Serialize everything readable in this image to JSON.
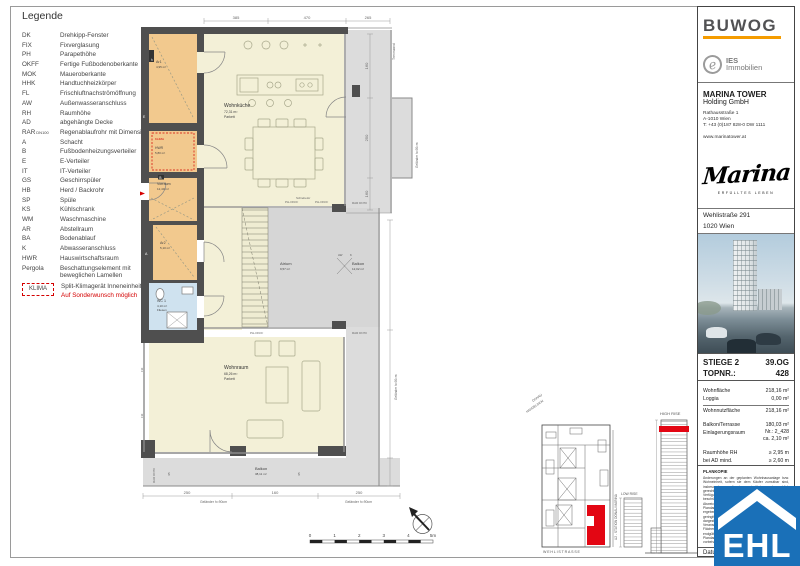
{
  "colors": {
    "red": "#e30613",
    "orange_bar": "#f59c00",
    "ehl_blue": "#1a70b8",
    "wall": "#4f4f4f",
    "room_cream": "#f3f0d7",
    "room_orange": "#f2c98e",
    "room_blue": "#cfe2ef",
    "terrace": "#dcdcdc"
  },
  "legend": {
    "title": "Legende",
    "rows": [
      {
        "abbr": "DK",
        "desc": "Drehkipp-Fenster"
      },
      {
        "abbr": "FIX",
        "desc": "Fixverglasung"
      },
      {
        "abbr": "PH",
        "desc": "Parapethöhe"
      },
      {
        "abbr": "OKFF",
        "desc": "Fertige Fußbodenoberkante"
      },
      {
        "abbr": "MOK",
        "desc": "Maueroberkante"
      },
      {
        "abbr": "HHK",
        "desc": "Handtuchheizkörper"
      },
      {
        "abbr": "FL",
        "desc": "Frischluftnachströmöffnung"
      },
      {
        "abbr": "AW",
        "desc": "Außenwasseranschluss"
      },
      {
        "abbr": "RH",
        "desc": "Raumhöhe"
      },
      {
        "abbr": "AD",
        "desc": "abgehängte Decke"
      },
      {
        "abbr": "RAR",
        "abbr_sub": "DN100",
        "desc": "Regenablaufrohr mit Dimension"
      },
      {
        "abbr": "A",
        "desc": "Schacht"
      },
      {
        "abbr": "B",
        "desc": "Fußbodenheizungsverteiler"
      },
      {
        "abbr": "E",
        "desc": "E-Verteiler"
      },
      {
        "abbr": "IT",
        "desc": "IT-Verteiler"
      },
      {
        "abbr": "GS",
        "desc": "Geschirrspüler"
      },
      {
        "abbr": "HB",
        "desc": "Herd / Backrohr"
      },
      {
        "abbr": "SP",
        "desc": "Spüle"
      },
      {
        "abbr": "KS",
        "desc": "Kühlschrank"
      },
      {
        "abbr": "WM",
        "desc": "Waschmaschine"
      },
      {
        "abbr": "AR",
        "desc": "Abstellraum"
      },
      {
        "abbr": "BA",
        "desc": "Bodenablauf"
      },
      {
        "abbr": "K",
        "desc": "Abwasseranschluss"
      },
      {
        "abbr": "HWR",
        "desc": "Hauswirtschaftsraum"
      },
      {
        "abbr": "Pergola",
        "desc": "Beschattungselement mit beweglichen Lamellen"
      }
    ],
    "klima": {
      "abbr": "KLIMA",
      "desc": "Split-Klimagerät Inneneinheit",
      "note": "Auf Sonderwunsch möglich"
    }
  },
  "plan": {
    "rooms": {
      "wohnkueche": {
        "name": "Wohnküche",
        "area": "72,31 m²",
        "floor": "Parkett"
      },
      "wohnraum": {
        "name": "Wohnraum",
        "area": "68,26 m²",
        "floor": "Parkett"
      },
      "vorraum": {
        "name": "Vorraum",
        "area": "12,40 m²"
      },
      "ar1": {
        "name": "Ar1",
        "area": "4,95 m²"
      },
      "hwr": {
        "name": "HWR",
        "area": "5,80 m²"
      },
      "ar2": {
        "name": "Ar2",
        "area": "5,10 m²"
      },
      "wc": {
        "name": "WC 1",
        "area": "4,10 m²",
        "floor": "Fliesen"
      },
      "atrium": {
        "name": "Atrium",
        "area": "9,57 m²"
      },
      "balkon_o": {
        "name": "Balkon",
        "area": "12,02 m²"
      },
      "balkon_u": {
        "name": "Balkon",
        "area": "38,11 m²"
      }
    },
    "marker": {
      "line1": "TOP",
      "line2": "428"
    },
    "labels": {
      "trennwand": "Trennwand",
      "gelaender": "Geländer h=90cm",
      "rar": "RAR DN70",
      "ph_okff": "PH-OKFF",
      "schiebetuer": "Schiebetür",
      "aw": "AW",
      "k": "K",
      "klima": "KLIMA",
      "it": "IT",
      "e": "E",
      "b": "B",
      "a": "A",
      "fix": "FIX"
    },
    "dims": {
      "top": [
        "385",
        "470",
        "265"
      ],
      "right": [
        "160",
        "250",
        "160"
      ],
      "bottom": [
        "250",
        "160",
        "250"
      ],
      "balcony": [
        "95",
        "95"
      ]
    }
  },
  "site_plan": {
    "street": "WEHLISTRASSE",
    "ubahn": "U2 - STATION DONAU MARINA",
    "donau": "DONAU",
    "handelskai": "HANDELSKAI",
    "low_rise": "LOW RISE",
    "high_rise": "HIGH RISE"
  },
  "scale_bar": {
    "labels": [
      "0",
      "1",
      "2",
      "3",
      "4",
      "5m"
    ]
  },
  "sidebar": {
    "buwog": "BUWOG",
    "ies": {
      "name": "IES",
      "sub": "Immobilien",
      "glyph": "e"
    },
    "company": {
      "name": "MARINA TOWER",
      "sub": "Holding GmbH",
      "address1": "Rathausstraße 1",
      "address2": "A-1010 Wien",
      "phone": "T: +43 (0)187 828-0 DW 1111",
      "web": "www.marinatower.at"
    },
    "marina": {
      "logo": "Marina",
      "tagline": "ERFÜLLTES LEBEN"
    },
    "project": {
      "street": "Wehlistraße 291",
      "city": "1020 Wien"
    },
    "unit": {
      "stiege": "STIEGE 2",
      "floor": "39.OG",
      "topnr_label": "TOPNR.:",
      "topnr": "428"
    },
    "areas": [
      {
        "label": "Wohnfläche",
        "value": "218,16 m²"
      },
      {
        "label": "Loggia",
        "value": "0,00 m²"
      },
      {
        "label": "Wohnnutzfläche",
        "value": "218,16 m²"
      },
      {
        "label": "Balkon/Terrasse",
        "value": "180,03 m²"
      },
      {
        "label": "Einlagerungsraum",
        "value": "Nr.: 2_428",
        "value2": "ca. 2,10 m²"
      },
      {
        "label": "Raumhöhe RH",
        "value": "≥  2,95 m"
      },
      {
        "label": "bei AD mind.",
        "value": "≥  2,60 m"
      }
    ],
    "plankopie": {
      "title": "PLANKOPIE",
      "text": "Änderungen an der geplanten Wohnhausanlage bzw. Wohneinheit, sofern sie dem Käufer zumutbar sind, insbesondere weil sie geringfügig und sachlich gerechtfertigt sind und allfällige Nutzungs- oder Verfügungsrechte des Käufers nicht unbillig beschränken, bleiben vorbehalten. Eine geringfügige Abweichung der Ausführung gegenüber der Plandarstellung kann sich im Zuge der Bauausführung ergeben. Alle Maßangaben sind Rohbaumaße; geringfügige Abweichungen bleiben vorbehalten. Die dargestellte Möblierung dient ausschließlich der Veranschaulichung und ist nicht Vertragsbestandteil. Flächenangaben gemäß Nutzwertgutachten. Die endgültige Ausführung kann in Details von der Plandarstellung abweichen. Satz- und Druckfehler vorbehalten."
    },
    "datum_label": "Datum",
    "ehl": "EHL"
  }
}
